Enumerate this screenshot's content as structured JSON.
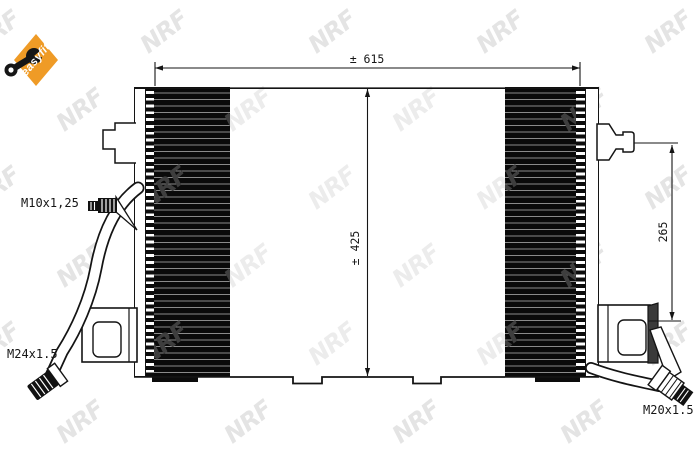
{
  "badge": {
    "label": "easyfit"
  },
  "watermark": {
    "text": "NRF"
  },
  "dimensions": {
    "width_label": "± 615",
    "height_label": "± 425",
    "side_label": "265"
  },
  "ports": {
    "left_top_thread": "M10x1,25",
    "left_bottom_thread": "M24x1.5",
    "right_bottom_thread": "M20x1.5"
  },
  "colors": {
    "badge_orange": "#ef9b26",
    "core_black": "#0a0a0a",
    "line": "#141414",
    "watermark_light": "#e4e4e4",
    "watermark_dark": "#3e3e3e",
    "watermark_glare": "#ececec"
  }
}
